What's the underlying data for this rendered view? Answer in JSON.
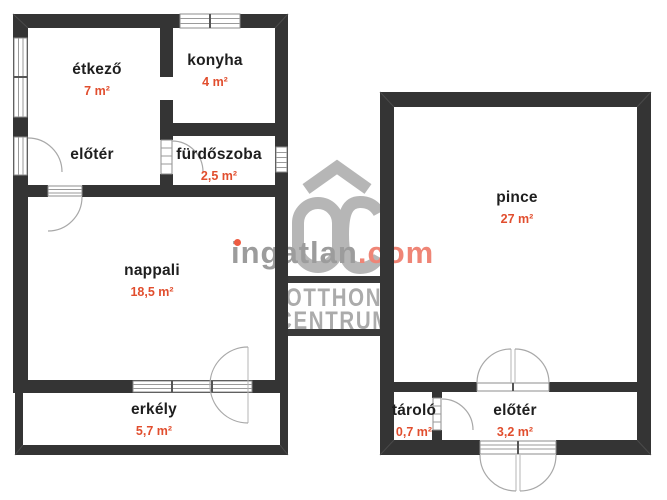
{
  "floor_plan": {
    "upper_plan": {
      "rooms": [
        {
          "name": "étkező",
          "area": "7 m²"
        },
        {
          "name": "konyha",
          "area": "4 m²"
        },
        {
          "name": "előtér",
          "area": ""
        },
        {
          "name": "fürdőszoba",
          "area": "2,5 m²"
        },
        {
          "name": "nappali",
          "area": "18,5 m²"
        },
        {
          "name": "erkély",
          "area": "5,7 m²"
        }
      ]
    },
    "basement_plan": {
      "rooms": [
        {
          "name": "pince",
          "area": "27 m²"
        },
        {
          "name": "tároló",
          "area": "0,7 m²"
        },
        {
          "name": "előtér",
          "area": "3,2 m²"
        }
      ]
    }
  },
  "watermark": {
    "brand_name": "ingatlan",
    "brand_tld": ".com",
    "agency_line1": "OTTHON",
    "agency_line2": "CENTRUM"
  },
  "colors": {
    "wall": "#343434",
    "room_label": "#1e1e1e",
    "area_label": "#e14e2e",
    "watermark_gray": "#b6b6b6",
    "watermark_text": "#ababab",
    "brand_gray": "#9c9c9c",
    "brand_tld_color": "#ef8576",
    "brand_dot": "#ee5b41"
  }
}
